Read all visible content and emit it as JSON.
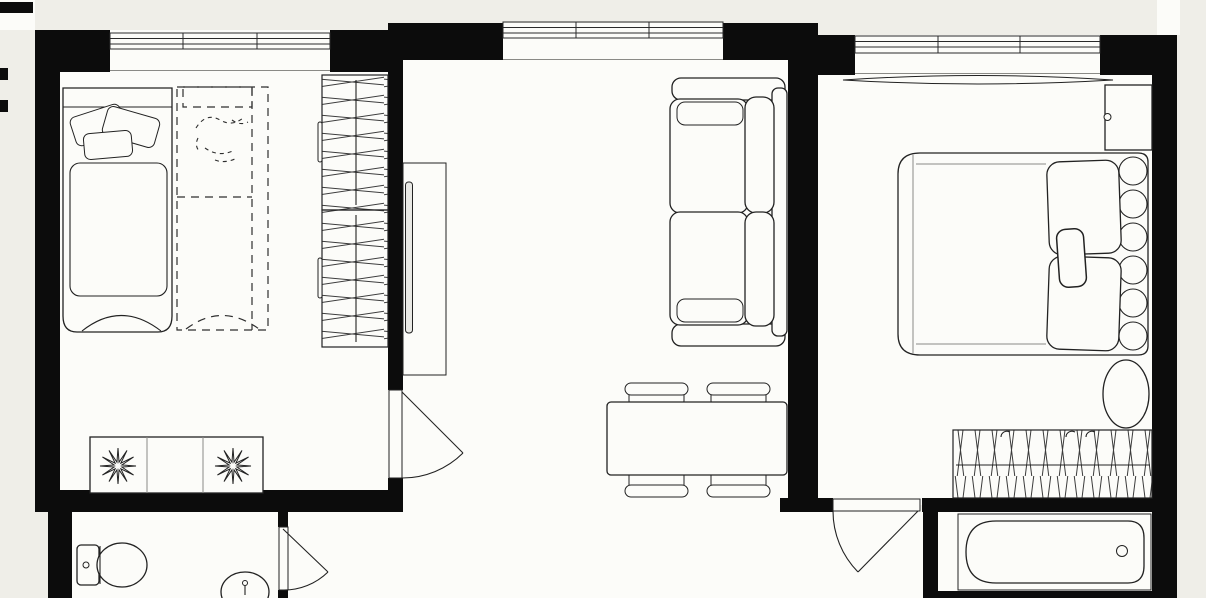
{
  "document": {
    "kind": "apartment floor plan",
    "style": "black-and-white top-down architectural drawing",
    "visible_text": "",
    "palette": {
      "background": "#efeee8",
      "floor": "#fcfcf9",
      "wall": "#0c0c0c",
      "line": "#222222"
    }
  },
  "rooms": [
    {
      "id": "bedroom-left",
      "label": "left bedroom",
      "furniture": [
        "single-bed-with-pillows",
        "dashed-planned-bed",
        "wardrobe-two-sections-hanging-clothes",
        "dresser-with-two-plants"
      ],
      "windows": 1,
      "doors": 1
    },
    {
      "id": "living-room",
      "label": "living room",
      "furniture": [
        "tv-console-with-tv",
        "two-seat-sofa",
        "dining-table",
        "four-chairs"
      ],
      "windows": 1,
      "doors": 1
    },
    {
      "id": "bedroom-right",
      "label": "right bedroom",
      "furniture": [
        "double-bed-with-pillows",
        "scalloped-headboard",
        "bedside-cabinet",
        "window-curtain",
        "oval-mirror",
        "built-in-wardrobe-hanging-clothes"
      ],
      "windows": 1,
      "doors": 1
    },
    {
      "id": "wc",
      "label": "toilet room",
      "furniture": [
        "toilet",
        "washbasin"
      ],
      "windows": 0,
      "doors": 1
    },
    {
      "id": "bathroom",
      "label": "bathtub room",
      "furniture": [
        "bathtub"
      ],
      "windows": 0,
      "doors": 0
    },
    {
      "id": "hallway",
      "label": "hallway",
      "furniture": [],
      "windows": 0,
      "doors": 0
    }
  ],
  "windows": [
    {
      "room": "bedroom-left",
      "panes": 3
    },
    {
      "room": "living-room",
      "panes": 3
    },
    {
      "room": "bedroom-right",
      "panes": 3
    }
  ],
  "doors": [
    {
      "from": "living-room",
      "to": "bedroom-left",
      "swing": "quarter-arc"
    },
    {
      "from": "hallway",
      "to": "bedroom-right",
      "swing": "quarter-arc"
    },
    {
      "from": "hallway",
      "to": "wc",
      "swing": "quarter-arc"
    }
  ]
}
